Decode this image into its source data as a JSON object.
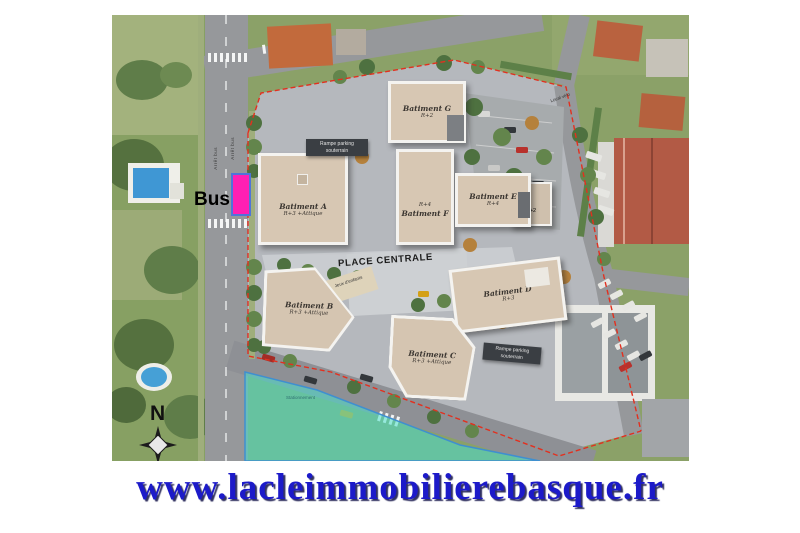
{
  "footer": {
    "url": "www.lacleimmobilierebasque.fr"
  },
  "plan": {
    "place_label": "PLACE CENTRALE",
    "playground_label": "Jeux d'enfants",
    "parking_ramp_label": "Rampe parking souterrain",
    "bus_label": "Bus",
    "bus_stop_label": "Arrêt bus",
    "parking_area_label": "Stationnement",
    "bike_room_label": "Local vélo",
    "north_label": "N",
    "buildings": {
      "a": {
        "name": "Batiment A",
        "floors": "R+3 +Attique"
      },
      "b": {
        "name": "Batiment B",
        "floors": "R+3 +Attique"
      },
      "c": {
        "name": "Batiment C",
        "floors": "R+3 +Attique"
      },
      "d": {
        "name": "Batiment D",
        "floors": "R+3"
      },
      "e": {
        "name": "Batiment E",
        "floors": "R+4",
        "wing_floors": "R+2"
      },
      "f": {
        "name": "Batiment F",
        "floors": "R+4"
      },
      "g": {
        "name": "Batiment G",
        "floors": "R+2"
      }
    },
    "colors": {
      "bus_highlight": "#ff1fb3",
      "future_zone": "#4fdccb",
      "boundary_line": "#e2301f",
      "url_blue": "#1c1ac9"
    }
  }
}
